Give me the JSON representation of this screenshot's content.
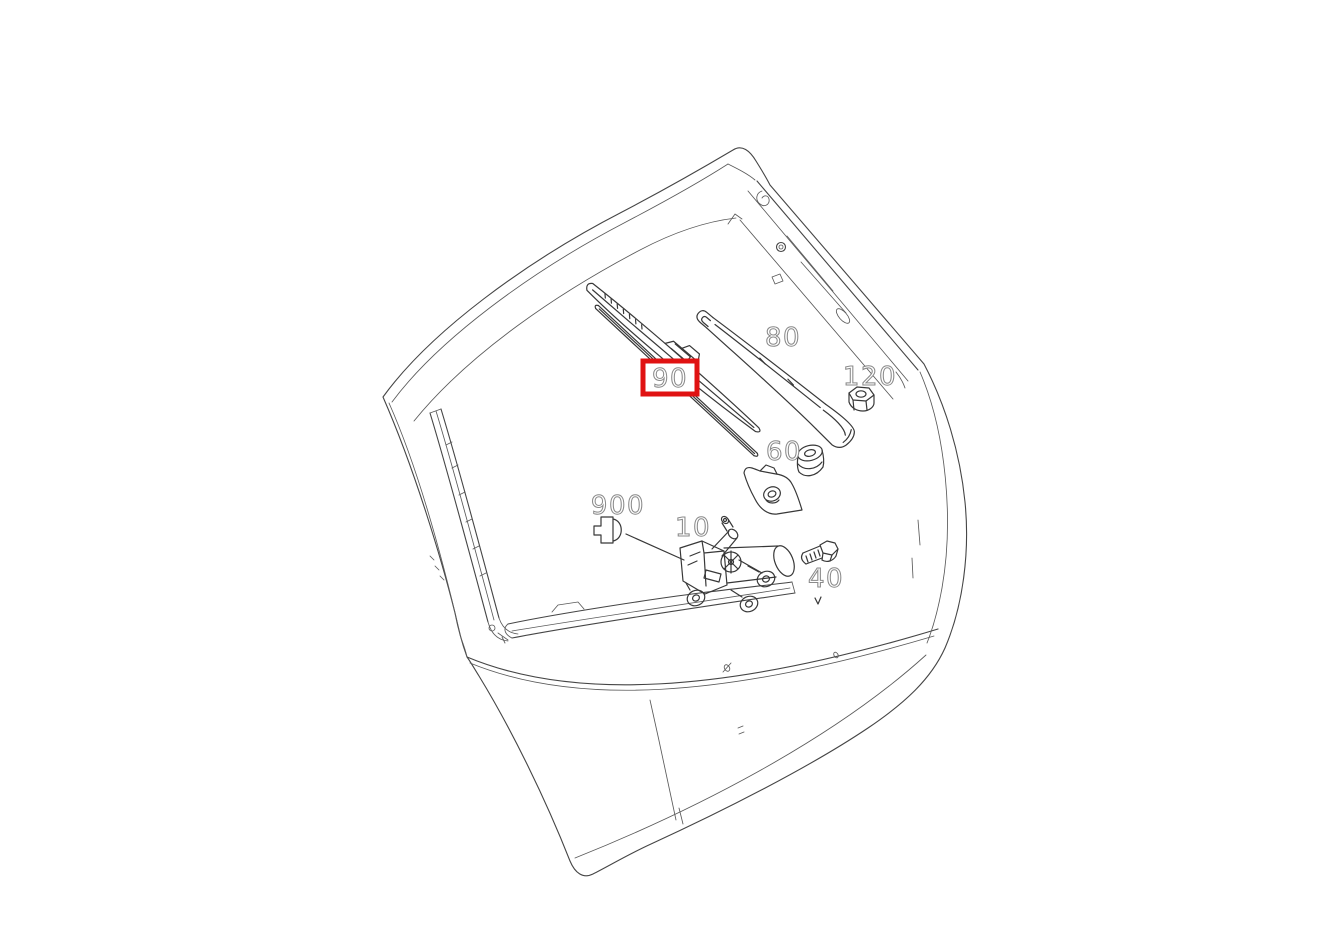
{
  "window": {
    "width": 1326,
    "height": 937,
    "background": "#ffffff"
  },
  "diagram": {
    "line_color": "#454545",
    "highlight_color": "#e01212",
    "label_fill": "#ffffff",
    "label_outline": "#8a8a8a",
    "callouts": [
      {
        "part_no": "80",
        "highlighted": false
      },
      {
        "part_no": "90",
        "highlighted": true
      },
      {
        "part_no": "120",
        "highlighted": false
      },
      {
        "part_no": "60",
        "highlighted": false
      },
      {
        "part_no": "900",
        "highlighted": false
      },
      {
        "part_no": "10",
        "highlighted": false
      },
      {
        "part_no": "40",
        "highlighted": false
      }
    ]
  }
}
